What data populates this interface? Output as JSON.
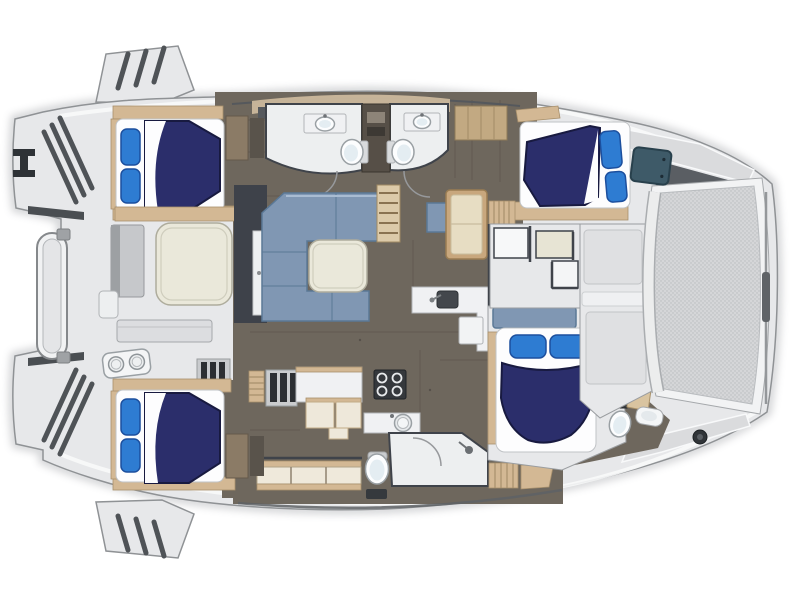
{
  "figure": {
    "kind": "catamaran-yacht-floor-plan-top-view",
    "cabins_with_double_beds": 4,
    "bathrooms_shown": 4,
    "visible_text": ""
  },
  "colors": {
    "deck_gray": "#e7e8ea",
    "deck_panel": "#dadbdd",
    "hull_stroke": "#8f9295",
    "gunwale_white": "#f8f9fa",
    "dark_wedge": "#5a5e63",
    "floor_brown": "#6e675d",
    "floor_seam": "#5d564d",
    "room_floor": "#edeff0",
    "wall_dark": "#3f434a",
    "wood_tan": "#d3b894",
    "wood_trim": "#a8906c",
    "bed_navy": "#2b2e6b",
    "bed_navy_edge": "#181a40",
    "pillow_blue": "#2e7cd2",
    "pillow_edge": "#1c4f9e",
    "mattress": "#fdfdfe",
    "sofa_blue": "#8097b3",
    "sofa_edge": "#5a7896",
    "table_cream": "#eae8da",
    "counter_white": "#f0f1f3",
    "appliance": "#35383c",
    "fixture": "#9aa0a4",
    "hatch_teal": "#3e5a68",
    "mesh_gray": "#d5d6d8",
    "mesh_dot": "#b9bcbf",
    "steel": "#4a4e52"
  },
  "elements": {
    "bow_side": "right",
    "stern_side": "left",
    "areas": [
      "swim-platform-steps",
      "dinghy-davit",
      "aft-cockpit",
      "cockpit-table",
      "salon-l-sofa",
      "salon-table",
      "chart-lounge",
      "wet-bar-sink",
      "galley-stove",
      "galley-sink",
      "twin-bathrooms-port",
      "shower-room-starboard",
      "port-aft-cabin-bed",
      "port-forward-cabin-bed",
      "starboard-aft-cabin-bed",
      "starboard-forward-cabin-bed",
      "forward-cockpit",
      "deck-hatch",
      "bow-trampoline",
      "anchor-winch"
    ]
  }
}
